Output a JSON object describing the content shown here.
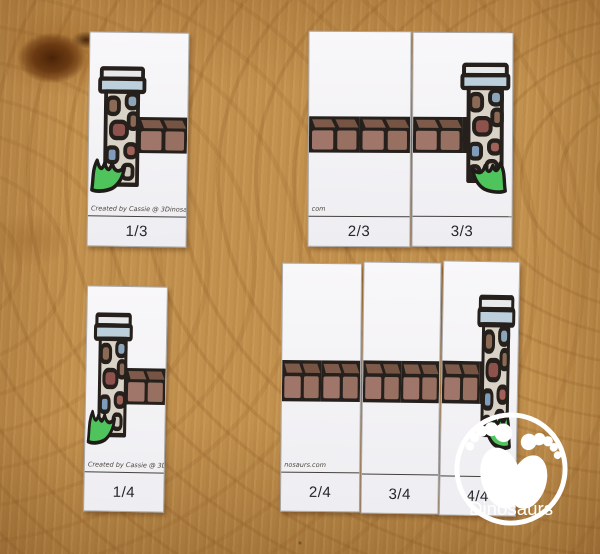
{
  "puzzles": {
    "thirds": {
      "pieces": [
        {
          "label": "1/3",
          "credit": "Created by Cassie @ 3Dinosaurs."
        },
        {
          "label": "2/3",
          "credit": "com"
        },
        {
          "label": "3/3",
          "credit": ""
        }
      ]
    },
    "fourths": {
      "pieces": [
        {
          "label": "1/4",
          "credit": "Created by Cassie @ 3D"
        },
        {
          "label": "2/4",
          "credit": "nosaurs.com"
        },
        {
          "label": "3/4",
          "credit": ""
        },
        {
          "label": "4/4",
          "credit": ""
        }
      ]
    }
  },
  "logo": {
    "number": "3",
    "name": "Dinosaurs"
  },
  "colors": {
    "wood": "#c2914e",
    "card": "#f5f4f6",
    "outline": "#26201c",
    "brick_front": "#a1766a",
    "brick_top": "#7d5a49",
    "tower_body": "#d9d2c7",
    "tower_cap": "#bccfdc",
    "grass": "#4fc45c",
    "logo_white": "#ffffff"
  }
}
